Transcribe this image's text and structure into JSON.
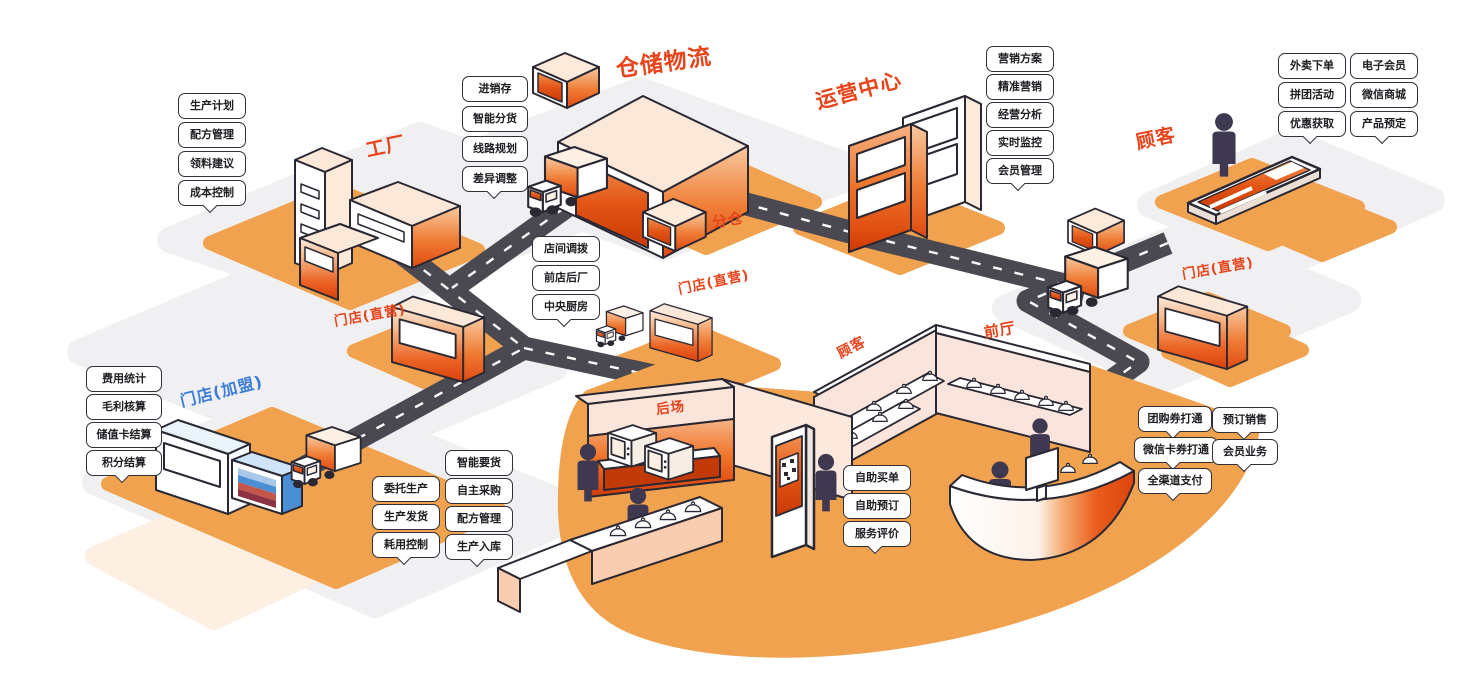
{
  "diagram": {
    "titles": {
      "factory": "工厂",
      "warehouse_logistics": "仓储物流",
      "operation_center": "运营中心",
      "customer": "顾客",
      "sub_warehouse": "分仓",
      "store_direct_left": "门店(直营)",
      "store_direct_center": "门店(直营)",
      "store_direct_right": "门店(直营)",
      "store_franchise": "门店(加盟)",
      "back_area": "后场",
      "customer_hall": "顾客",
      "front_hall": "前厅"
    },
    "label_groups": {
      "factory": [
        "生产计划",
        "配方管理",
        "领料建议",
        "成本控制"
      ],
      "warehouse": [
        "进销存",
        "智能分货",
        "线路规划",
        "差异调整"
      ],
      "allocation": [
        "店间调拨",
        "前店后厂",
        "中央厨房"
      ],
      "operation": [
        "营销方案",
        "精准营销",
        "经营分析",
        "实时监控",
        "会员管理"
      ],
      "customer_col1": [
        "外卖下单",
        "拼团活动",
        "优惠获取"
      ],
      "customer_col2": [
        "电子会员",
        "微信商城",
        "产品预定"
      ],
      "franchise": [
        "费用统计",
        "毛利核算",
        "储值卡结算",
        "积分结算"
      ],
      "production_col1": [
        "委托生产",
        "生产发货",
        "耗用控制"
      ],
      "production_col2": [
        "智能要货",
        "自主采购",
        "配方管理",
        "生产入库"
      ],
      "self_service": [
        "自助买单",
        "自助预订",
        "服务评价"
      ],
      "payment_col1": [
        "团购券打通",
        "微信卡券打通",
        "全渠道支付"
      ],
      "payment_col2": [
        "预订销售",
        "会员业务"
      ]
    },
    "colors": {
      "accent": "#e8441b",
      "franchise_blue": "#3b7dd8",
      "platform_orange": "#f0a24f",
      "road": "#4a4952",
      "wall_pink": "#fbe4dc",
      "people": "#3e3950"
    }
  }
}
